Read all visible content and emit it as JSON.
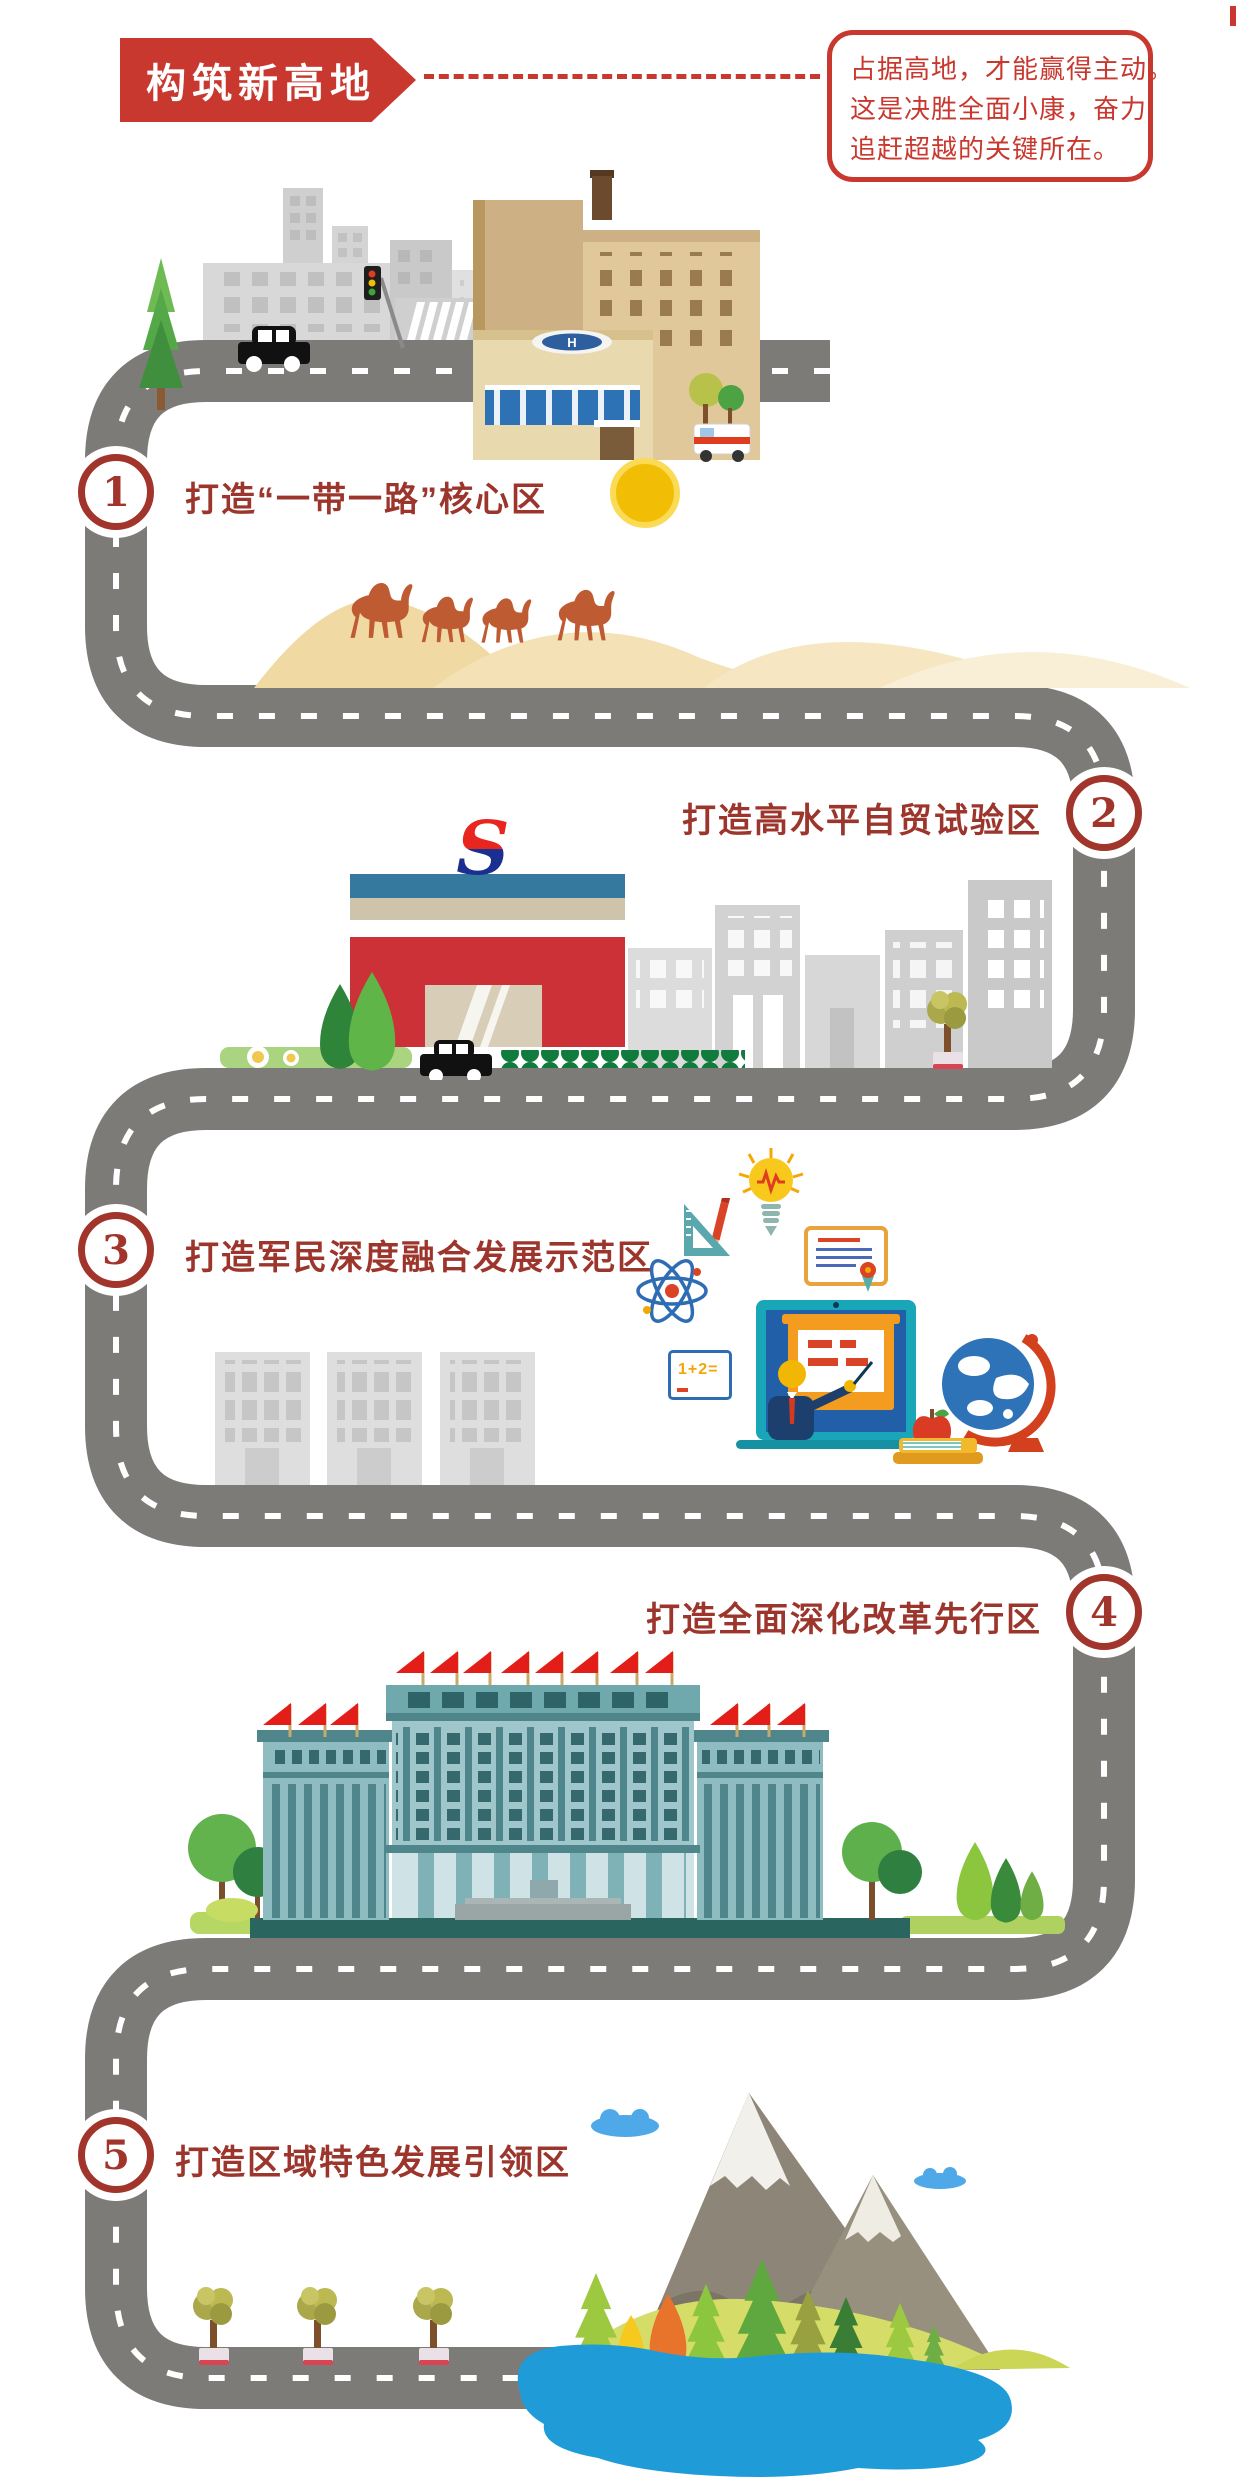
{
  "title_banner": {
    "label": "构筑新高地"
  },
  "quote_box": {
    "line1": "占据高地，才能赢得主动。",
    "line2": "这是决胜全面小康，奋力",
    "line3": "追赶超越的关键所在。"
  },
  "milestones": [
    {
      "number": "1",
      "label": "打造“一带一路”核心区",
      "scene": "city-and-hospital-desert-camels"
    },
    {
      "number": "2",
      "label": "打造高水平自贸试验区",
      "scene": "free-trade-zone-building"
    },
    {
      "number": "3",
      "label": "打造军民深度融合发展示范区",
      "scene": "education-science-icons"
    },
    {
      "number": "4",
      "label": "打造全面深化改革先行区",
      "scene": "government-building-with-flags"
    },
    {
      "number": "5",
      "label": "打造区域特色发展引领区",
      "scene": "mountains-forest-lake"
    }
  ],
  "scene_labels": {
    "helipad_letter": "H",
    "logo_letter": "S",
    "math_board": "1+2="
  },
  "icons": [
    "city-buildings-icon",
    "pine-tree-icon",
    "car-icon",
    "traffic-light-icon",
    "crosswalk-icon",
    "hospital-building-icon",
    "ambulance-icon",
    "sun-icon",
    "sand-dunes-icon",
    "camel-icon",
    "free-trade-building-icon",
    "company-logo-icon",
    "hedge-icon",
    "grass-strip-icon",
    "potted-tree-icon",
    "office-buildings-icon",
    "lightbulb-icon",
    "set-square-pencil-icon",
    "atom-icon",
    "certificate-icon",
    "math-board-icon",
    "laptop-teacher-icon",
    "globe-icon",
    "apple-icon",
    "books-icon",
    "gray-buildings-icon",
    "government-building-icon",
    "red-flag-icon",
    "round-tree-icon",
    "mountain-icon",
    "cloud-icon",
    "lake-icon",
    "winding-road",
    "milestone-badge"
  ],
  "colors": {
    "banner_red": "#c9382f",
    "label_maroon": "#9c352c",
    "badge_ring": "#a1352b",
    "road_gray": "#7d7b78",
    "road_dash": "#ffffff",
    "sun_yellow": "#f2bd05",
    "sand": "#f0d9a2",
    "camel": "#bf5b33",
    "hospital_tan": "#e0c89a",
    "helipad_blue": "#2d5f9e",
    "trade_red": "#cb3136",
    "trade_blue_band": "#35799f",
    "logo_red": "#e8251f",
    "logo_navy": "#1a2f8f",
    "gov_teal": "#9fc6ca",
    "flag_red": "#e31e18",
    "mountain_gray": "#8d8577",
    "lake_blue": "#1f9cd8",
    "pine_green": "#5fa83f"
  }
}
